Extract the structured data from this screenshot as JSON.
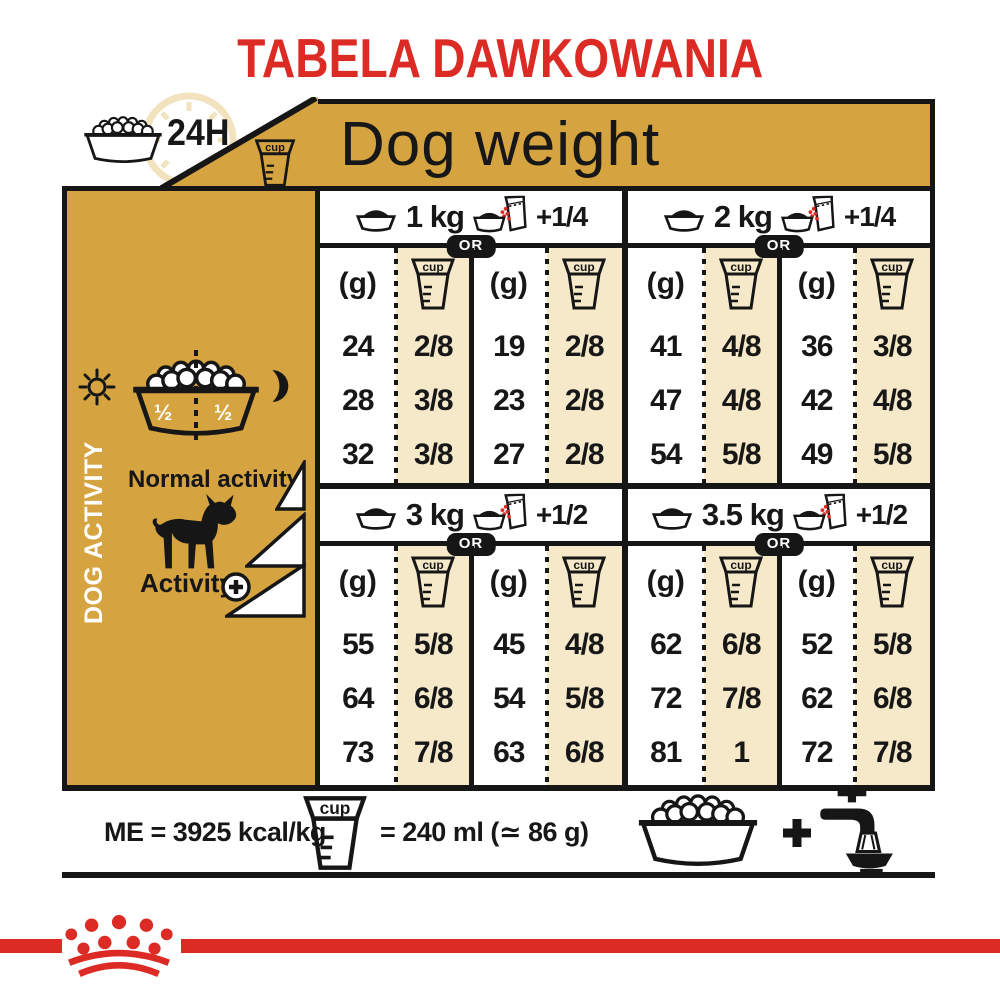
{
  "title": "TABELA DAWKOWANIA",
  "header": {
    "daily_ration_label": "24H",
    "dog_weight_label": "Dog weight"
  },
  "sidebar": {
    "vertical_label": "DOG ACTIVITY",
    "half_left": "½",
    "half_right": "½",
    "normal_activity_label": "Normal activity",
    "activity_label": "Activity",
    "activity_plus_symbol": "+"
  },
  "table": {
    "or_label": "OR",
    "grams_unit_label": "(g)",
    "cup_icon_label": "cup",
    "groups": [
      {
        "weight": "1 kg",
        "extra": "+1/4",
        "grams": [
          24,
          28,
          32
        ],
        "cups": [
          "2/8",
          "3/8",
          "3/8"
        ],
        "alt_grams": [
          19,
          23,
          27
        ],
        "alt_cups": [
          "2/8",
          "2/8",
          "2/8"
        ]
      },
      {
        "weight": "2 kg",
        "extra": "+1/4",
        "grams": [
          41,
          47,
          54
        ],
        "cups": [
          "4/8",
          "4/8",
          "5/8"
        ],
        "alt_grams": [
          36,
          42,
          49
        ],
        "alt_cups": [
          "3/8",
          "4/8",
          "5/8"
        ]
      },
      {
        "weight": "3 kg",
        "extra": "+1/2",
        "grams": [
          55,
          64,
          73
        ],
        "cups": [
          "5/8",
          "6/8",
          "7/8"
        ],
        "alt_grams": [
          45,
          54,
          63
        ],
        "alt_cups": [
          "4/8",
          "5/8",
          "6/8"
        ]
      },
      {
        "weight": "3.5 kg",
        "extra": "+1/2",
        "grams": [
          62,
          72,
          81
        ],
        "cups": [
          "6/8",
          "7/8",
          "1"
        ],
        "alt_grams": [
          52,
          62,
          72
        ],
        "alt_cups": [
          "5/8",
          "6/8",
          "7/8"
        ]
      }
    ]
  },
  "footer": {
    "energy_label": "ME = 3925 kcal/kg",
    "cup_equivalence_label": "= 240 ml (≃ 86 g)",
    "plus_symbol": "+"
  },
  "colors": {
    "gold": "#D5A440",
    "beige": "#F6E9C9",
    "red": "#DC2A24",
    "black": "#161616",
    "clock_beige": "#F2E3BE"
  }
}
